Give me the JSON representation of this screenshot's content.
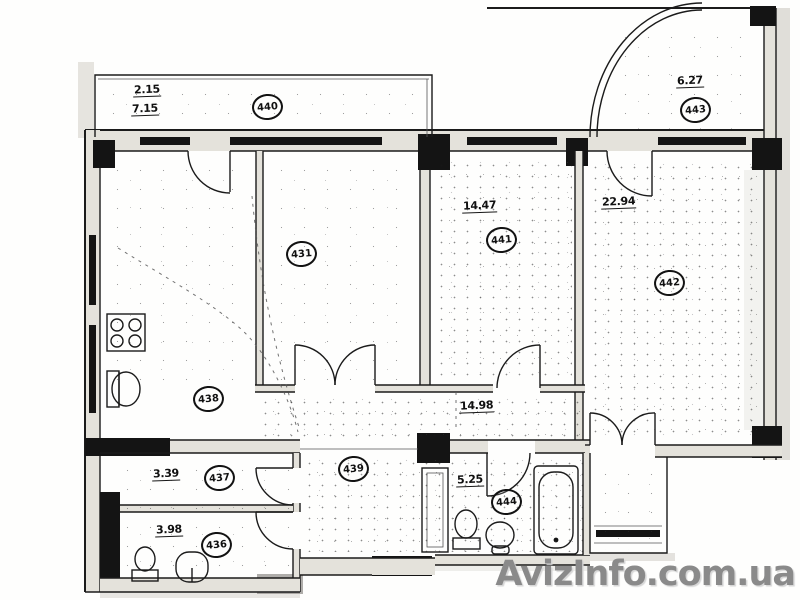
{
  "page": {
    "kind": "scanned apartment floor plan"
  },
  "watermark": {
    "text": "AvizInfo.com.ua",
    "color": "#8a8a8a"
  },
  "plan": {
    "ink_color": "#1b1b1b",
    "paper_color": "#ffffff",
    "labels": {
      "b440": {
        "number": "440",
        "dim1": "2.15",
        "dim2": "7.15"
      },
      "b443": {
        "number": "443",
        "dim": "6.27"
      },
      "r431": {
        "number": "431"
      },
      "r441": {
        "number": "441",
        "dim": "14.47"
      },
      "r442": {
        "number": "442",
        "dim": "22.94"
      },
      "r438": {
        "number": "438"
      },
      "r439": {
        "number": "439",
        "dim": "14.98"
      },
      "r437": {
        "number": "437",
        "dim": "3.39"
      },
      "r436": {
        "number": "436",
        "dim": "3.98"
      },
      "r444": {
        "number": "444",
        "dim": "5.25"
      }
    },
    "fixtures": [
      "stove-icon",
      "kitchen-sink-icon",
      "toilet-icon",
      "washbasin-icon",
      "bathtub-icon"
    ],
    "features": [
      "windows",
      "columns",
      "door-arcs",
      "curved-balcony",
      "duct-shaft",
      "entrance-door"
    ]
  }
}
